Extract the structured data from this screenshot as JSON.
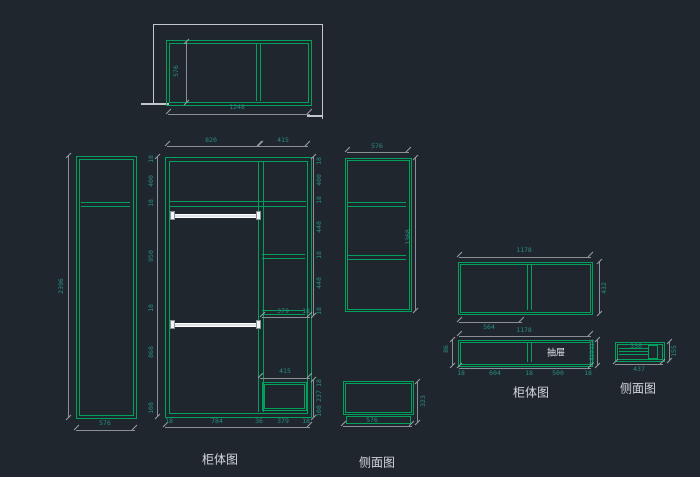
{
  "view": {
    "background": "#1f262e"
  },
  "palette": {
    "line_green": "#00a15c",
    "dim_text": "#2a8d7f",
    "dim_line": "#8a9096",
    "wall_gray": "#c2c7cc",
    "title_text": "#d2d6da",
    "rod_white": "#eef2f4"
  },
  "titles": {
    "cabinet_view_left": "柜体图",
    "side_view_left": "侧面图",
    "cabinet_view_right": "柜体图",
    "side_view_right": "侧面图"
  },
  "top_view": {
    "depth": "576",
    "width": "1248"
  },
  "left_cabinet": {
    "height": "2396",
    "width": "576"
  },
  "main_cabinet": {
    "top_widths": [
      "820",
      "415"
    ],
    "bottom_widths": [
      "18",
      "784",
      "36",
      "379",
      "18"
    ],
    "left_heights": [
      "18",
      "400",
      "18",
      "950",
      "18",
      "868",
      "108"
    ],
    "right_heights": [
      "18",
      "400",
      "18",
      "448",
      "18",
      "448",
      "18"
    ],
    "right_lower_heights": [
      "18",
      "237",
      "108"
    ],
    "shelf_width": "379",
    "shelf_edge": "18",
    "shoe_shelf_width": "415"
  },
  "tall_side_view": {
    "width": "576",
    "height": "1368"
  },
  "small_side_view": {
    "height": "323",
    "width": "576"
  },
  "upper_cabinet": {
    "width": "1178",
    "height": "432",
    "left_section_width": "564"
  },
  "drawer_cabinet": {
    "width": "1178",
    "left_height": "86",
    "right_heights": [
      "18",
      "191",
      "18"
    ],
    "bottom_widths": [
      "18",
      "604",
      "18",
      "500",
      "18"
    ],
    "drawer_label": "抽屉"
  },
  "drawer_side_view": {
    "slide_width": "336",
    "width": "437",
    "height": "155"
  }
}
